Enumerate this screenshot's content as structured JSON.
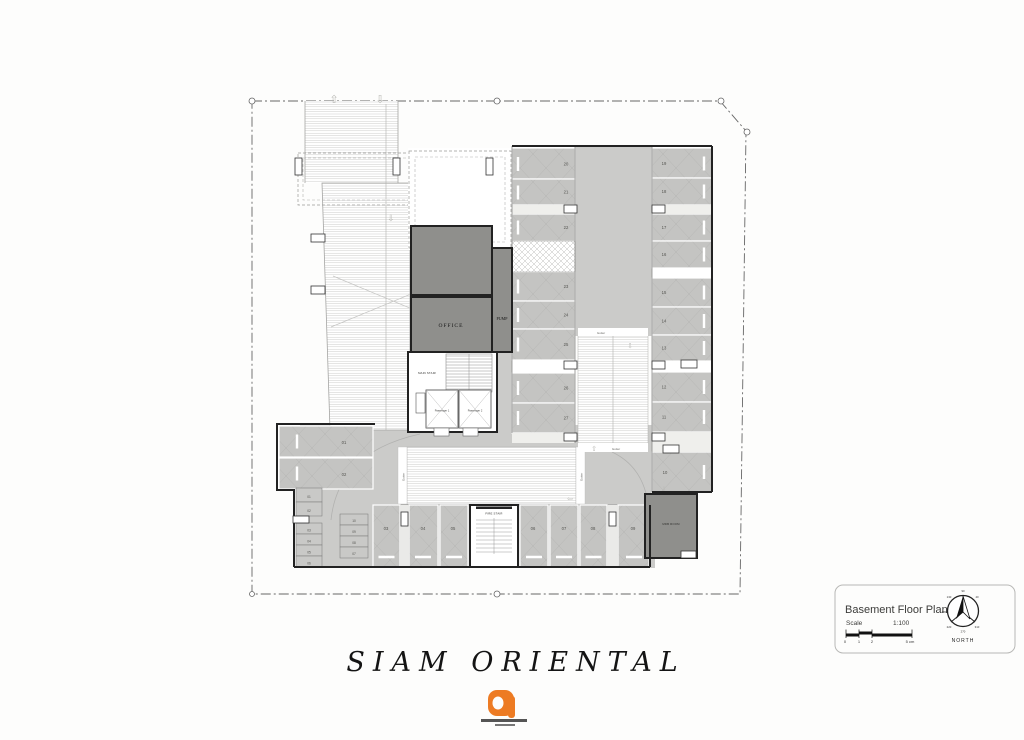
{
  "title": "SIAM ORIENTAL",
  "plan": {
    "rooms": {
      "office": "OFFICE",
      "pump": "PUMP",
      "main_stair": "MAIN STAIR",
      "fire_stair": "FIRE STAIR",
      "mdb_room": "MDB ROOM"
    },
    "elevators": {
      "p1": "Passenger 1",
      "p2": "Passenger 2"
    },
    "gutter": "Gutter",
    "stalls": {
      "left": [
        "20",
        "21",
        "22",
        "23",
        "24",
        "25",
        "26",
        "27"
      ],
      "right": [
        "19",
        "18",
        "17",
        "16",
        "15",
        "14",
        "13",
        "12",
        "11"
      ],
      "stall_10": "10",
      "bottom": [
        "03",
        "04",
        "05",
        "06",
        "07",
        "08",
        "09"
      ],
      "side": [
        "01",
        "02"
      ],
      "bay_a": [
        "01",
        "02",
        "03",
        "04",
        "05",
        "06"
      ],
      "bay_b": [
        "10",
        "09",
        "08",
        "07"
      ]
    }
  },
  "titleblock": {
    "name": "Basement Floor Plan",
    "scale_label": "Scale",
    "scale_value": "1:100",
    "ticks": [
      "0",
      "1",
      "2",
      "5 cm"
    ],
    "north_label": "NORTH",
    "degrees": [
      "90",
      "40",
      "130",
      "180",
      "220",
      "270",
      "310"
    ]
  },
  "colors": {
    "accent": "#ED7B23",
    "stall": "#c4c4c2",
    "aisle": "#cbcbc9",
    "room": "#8f8f8c"
  }
}
